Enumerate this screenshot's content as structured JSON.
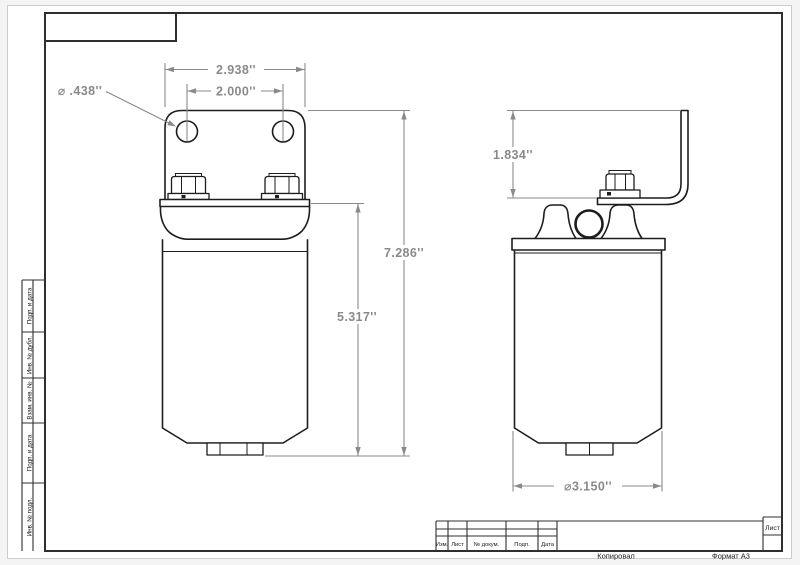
{
  "colors": {
    "line": "#1d1d1d",
    "dim": "#8a8a8a",
    "frame": "#2f2f2f",
    "text": "#1a1a1a",
    "paper_border": "#cccccc"
  },
  "dimensions": {
    "bracket_width": "2.938''",
    "hole_spacing": "2.000''",
    "hole_diameter": "⌀ .438''",
    "overall_height": "7.286''",
    "body_height": "5.317''",
    "bracket_height": "1.834''",
    "body_diameter": "⌀3.150''"
  },
  "drawing_frame": {
    "left_strip": {
      "cells": [
        {
          "label": "Подп. и дата"
        },
        {
          "label": "Инв. № дубл."
        },
        {
          "label": "Взам. инв. №"
        },
        {
          "label": "Подп. и дата"
        },
        {
          "label": "Инв. № подл."
        }
      ]
    },
    "title_block": {
      "header_columns": [
        "Изм.",
        "Лист",
        "№ докум.",
        "Подп.",
        "Дата"
      ],
      "sheet_label": "Лист",
      "footer": {
        "copied": "Копировал",
        "format": "Формат А3"
      }
    }
  }
}
